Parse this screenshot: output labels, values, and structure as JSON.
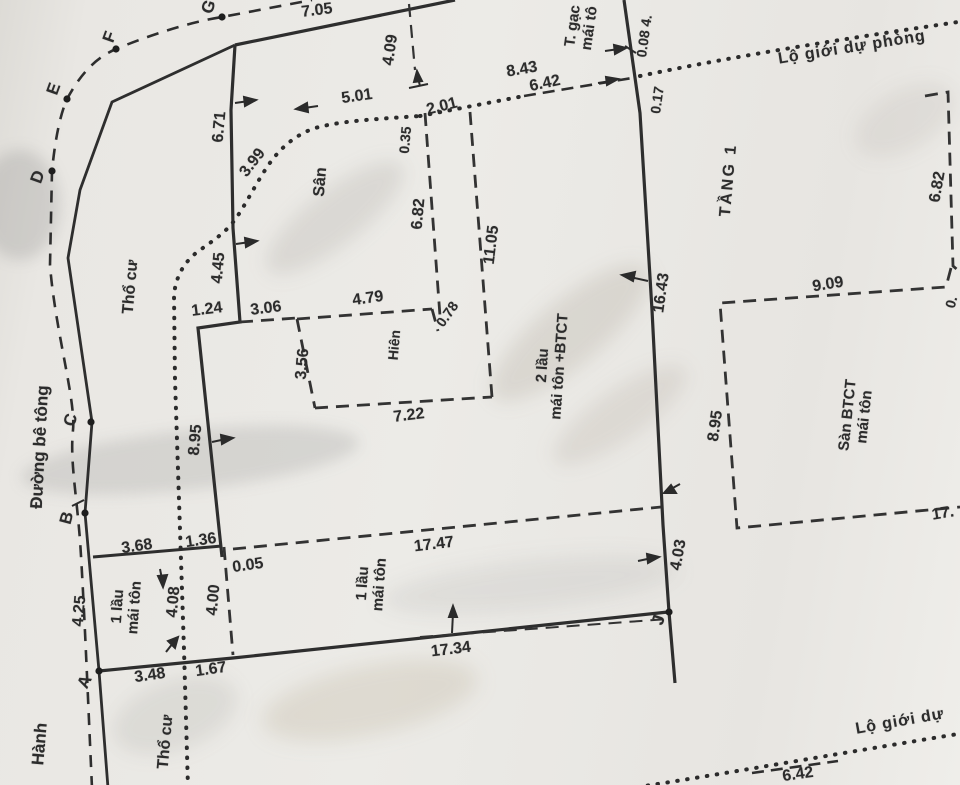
{
  "drawing": {
    "type": "cadastral-survey-sketch",
    "road": {
      "name": "Đường bê tông",
      "hanh": "Hành"
    },
    "points": {
      "A": "A",
      "B": "B",
      "C": "C",
      "D": "D",
      "E": "E",
      "F": "F",
      "G": "G",
      "J": "J"
    },
    "land": {
      "tho_cu_upper": "Thổ cư",
      "tho_cu_lower": "Thổ cư",
      "san": "Sân",
      "hien": "Hiên",
      "tang1": "TẦNG 1"
    },
    "setback": {
      "top": "Lộ giới dự phòng",
      "bottom": "Lộ giới dự"
    },
    "buildings": {
      "left_small": {
        "line1": "1 lầu",
        "line2": "mái tôn"
      },
      "bottom_main": {
        "line1": "1 lầu",
        "line2": "mái tôn"
      },
      "two_storey": {
        "line1": "2 lầu",
        "line2": "mái tôn +BTCT"
      },
      "top_right": {
        "line1": "T. gạc",
        "line2": "mái tô"
      },
      "right_slab": {
        "line1": "Sàn BTCT",
        "line2": "mái tôn"
      }
    },
    "dimensions": {
      "d7_05": "7.05",
      "d6_71": "6.71",
      "d4_45": "4.45",
      "d1_24": "1.24",
      "d3_06": "3.06",
      "d3_99": "3.99",
      "d5_01": "5.01",
      "d4_09": "4.09",
      "d0_35": "0.35",
      "d2_01": "2.01",
      "d6_82a": "6.82",
      "d11_05": "11.05",
      "d4_79": "4.79",
      "d0_78": "0.78",
      "d3_56": "3.56",
      "d7_22": "7.22",
      "d8_43": "8.43",
      "d6_42a": "6.42",
      "d0_08": "0.08 4.",
      "d0_17": "0.17",
      "d16_43": "16.43",
      "d8_95a": "8.95",
      "d8_95b": "8.95",
      "d9_09": "9.09",
      "d6_82b": "6.82",
      "d17cut": "17.",
      "d0cut": "0.",
      "d17_47": "17.47",
      "d17_34": "17.34",
      "d4_03": "4.03",
      "d3_68": "3.68",
      "d1_36": "1.36",
      "d0_05": "0.05",
      "d4_25": "4.25",
      "d4_08": "4.08",
      "d4_00": "4.00",
      "d3_48": "3.48",
      "d1_67": "1.67",
      "d6_42b": "6.42"
    }
  }
}
